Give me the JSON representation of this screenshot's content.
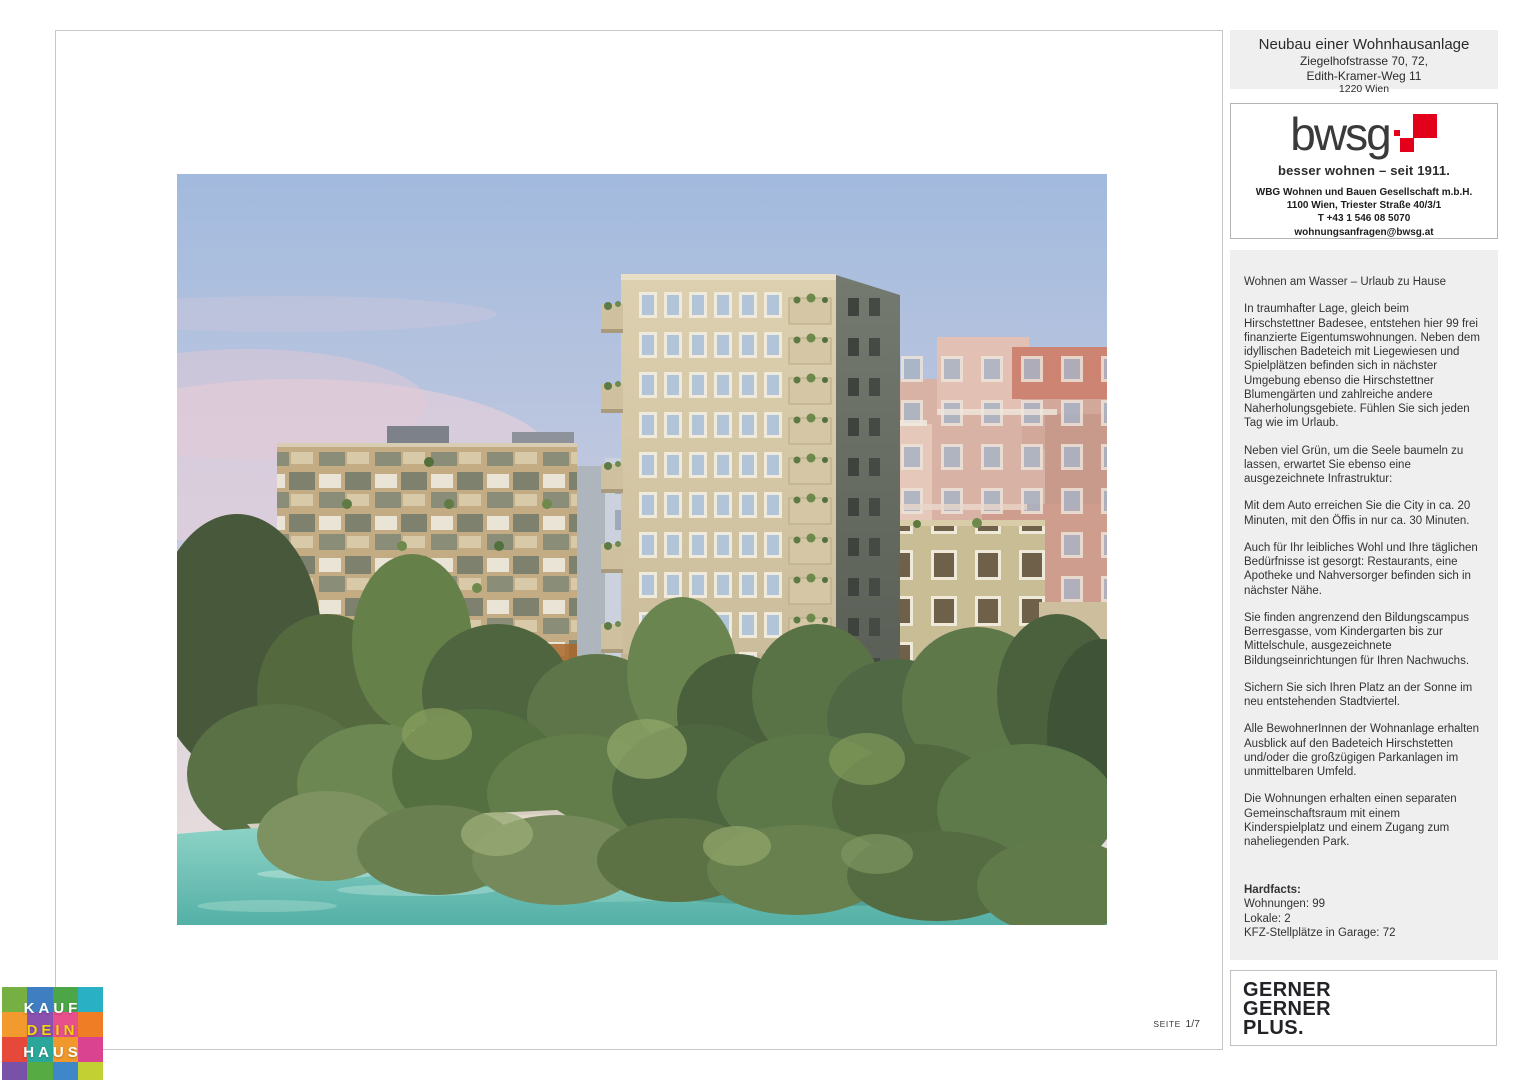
{
  "header": {
    "title": "Neubau einer Wohnhausanlage",
    "address_line1": "Ziegelhofstrasse 70, 72,",
    "address_line2": "Edith-Kramer-Weg 11",
    "address_line3": "1220 Wien"
  },
  "developer": {
    "logo_text": "bwsg",
    "brand_red": "#e2001a",
    "tagline": "besser wohnen – seit 1911.",
    "company": "WBG Wohnen und Bauen Gesellschaft m.b.H.",
    "address": "1100 Wien, Triester Straße 40/3/1",
    "phone": "T +43 1 546 08 5070",
    "email": "wohnungsanfragen@bwsg.at"
  },
  "body": {
    "headline": "Wohnen am Wasser – Urlaub zu Hause",
    "paragraphs": [
      "In traumhafter Lage, gleich beim Hirschstettner Badesee, entstehen hier 99 frei finanzierte Eigentumswohnungen. Neben dem idyllischen Badeteich mit Liegewiesen und Spielplätzen befinden sich in nächster Umgebung ebenso die Hirschstettner Blumengärten und zahlreiche andere Naherholungsgebiete. Fühlen Sie sich jeden Tag wie im Urlaub.",
      "Neben viel Grün, um die Seele baumeln zu lassen, erwartet Sie ebenso eine ausgezeichnete Infrastruktur:",
      "Mit dem Auto erreichen Sie die City in ca. 20 Minuten, mit den Öffis in nur ca. 30 Minuten.",
      "Auch für Ihr leibliches Wohl und Ihre täglichen Bedürfnisse ist gesorgt: Restaurants, eine Apotheke und Nahversorger befinden sich in nächster Nähe.",
      "Sie finden angrenzend den Bildungscampus Berresgasse, vom Kindergarten bis zur Mittelschule, ausgezeichnete Bildungseinrichtungen für Ihren Nachwuchs.",
      "Sichern Sie sich Ihren Platz an der Sonne im neu entstehenden Stadtviertel.",
      "Alle BewohnerInnen der Wohnanlage erhalten Ausblick auf den Badeteich Hirschstetten und/oder die großzügigen Parkanlagen im unmittelbaren Umfeld.",
      "Die Wohnungen erhalten einen separaten Gemeinschaftsraum mit einem Kinderspielplatz und einem Zugang zum naheliegenden Park."
    ]
  },
  "hardfacts": {
    "label": "Hardfacts:",
    "items": [
      "Wohnungen: 99",
      "Lokale: 2",
      "KFZ-Stellplätze in Garage: 72"
    ]
  },
  "footer": {
    "page_label": "SEITE",
    "page_number": "1/7",
    "architect_lines": [
      "GERNER",
      "GERNER",
      "PLUS."
    ]
  },
  "kaufdeinhaus": {
    "lines": [
      "KAUF",
      "DEIN",
      "HAUS"
    ],
    "text_colors": [
      "#ffffff",
      "#f2d410",
      "#ffffff"
    ],
    "grid_colors": [
      [
        "#76b043",
        "#3f7fc1",
        "#4ca546",
        "#2ab0c5"
      ],
      [
        "#f29a2e",
        "#8a51ae",
        "#e84f8d",
        "#ef7d26"
      ],
      [
        "#e6483a",
        "#2aa79a",
        "#f0982b",
        "#d94390"
      ],
      [
        "#7851a8",
        "#57ab43",
        "#3e87c9",
        "#c3d034"
      ],
      [
        "#3396d4",
        "#f0a02f",
        "#dd3d34",
        "#4aa04b"
      ]
    ]
  }
}
